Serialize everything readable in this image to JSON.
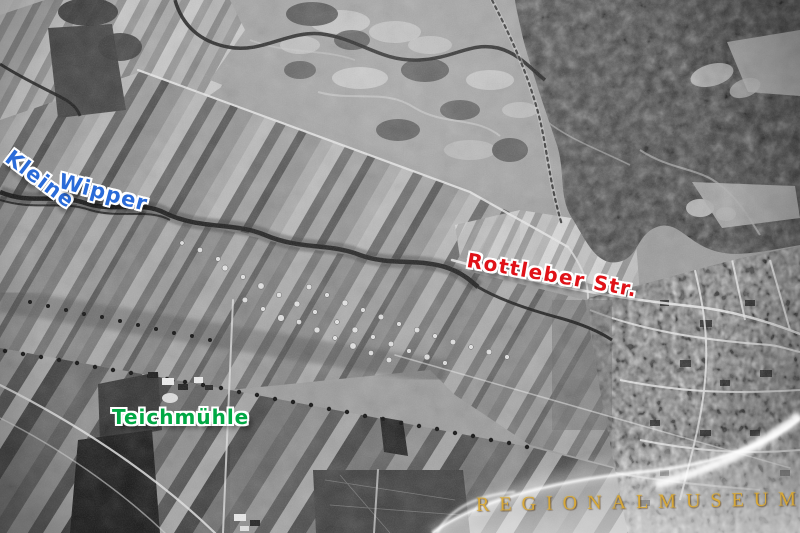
{
  "labels": {
    "river_word1": "Kleine",
    "river_word2": "Wipper",
    "street": "Rottleber Str.",
    "mill": "Teichmühle",
    "watermark": "REGIONALMUSEUM"
  },
  "colors": {
    "river_label": "#2a6bd8",
    "street_label": "#e01218",
    "mill_label": "#00a844",
    "watermark_text": "#d9a62e"
  }
}
